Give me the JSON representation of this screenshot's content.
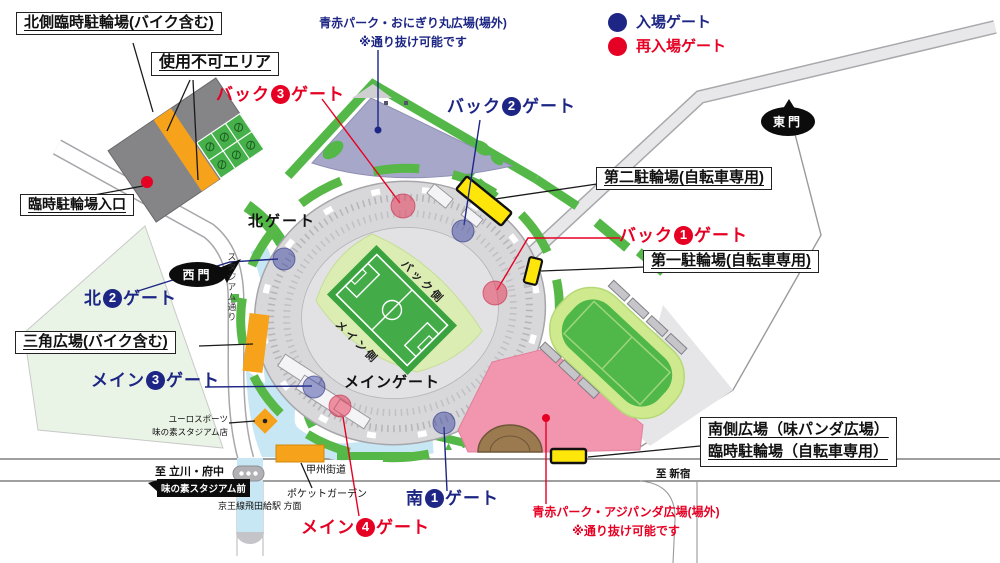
{
  "legend": {
    "entry_label": "入場ゲート",
    "reentry_label": "再入場ゲート"
  },
  "colors": {
    "entry_gate": "#1d2684",
    "reentry_gate": "#e60023",
    "park_green": "#53b848",
    "marker_yellow": "#ffe60a",
    "plaza_pink": "#f295af",
    "plaza_purple": "#a7a7c9",
    "walkway_blue": "#c8e7f4",
    "parking_orange": "#f7a21b"
  },
  "boxes": {
    "north_parking": "北側臨時駐輪場(バイク含む)",
    "unusable_area": "使用不可エリア",
    "temp_entrance": "臨時駐輪場入口",
    "triangle_plaza": "三角広場(バイク含む)",
    "bicycle2": "第二駐輪場(自転車専用)",
    "bicycle1": "第一駐輪場(自転車専用)",
    "south_plaza1": "南側広場（味パンダ広場）",
    "south_plaza2": "臨時駐輪場（自転車専用）"
  },
  "gates": {
    "back3": {
      "pre": "バック",
      "num": "3",
      "post": "ゲート"
    },
    "back2": {
      "pre": "バック",
      "num": "2",
      "post": "ゲート"
    },
    "back1": {
      "pre": "バック",
      "num": "1",
      "post": "ゲート"
    },
    "north2": {
      "pre": "北",
      "num": "2",
      "post": "ゲート"
    },
    "main3": {
      "pre": "メイン",
      "num": "3",
      "post": "ゲート"
    },
    "main4": {
      "pre": "メイン",
      "num": "4",
      "post": "ゲート"
    },
    "south1": {
      "pre": "南",
      "num": "1",
      "post": "ゲート"
    },
    "north": "北ゲート",
    "main": "メインゲート",
    "east_mon": "東門",
    "west_mon": "西門"
  },
  "plazas": {
    "onigiri_line1": "青赤パーク・おにぎり丸広場(場外)",
    "onigiri_line2": "※通り抜け可能です",
    "ajipanda_line1": "青赤パーク・アジパンダ広場(場外)",
    "ajipanda_line2": "※通り抜け可能です"
  },
  "stadium": {
    "back_side": "バック側",
    "main_side": "メイン側"
  },
  "streets": {
    "koshu_kaido": "甲州街道",
    "stadium_street": "スタジアム通り",
    "to_tachikawa": "至 立川・府中",
    "to_shinjuku": "至 新宿",
    "station_stop": "味の素スタジアム前",
    "station_direction": "京王線飛田給駅 方面",
    "pocket_garden": "ポケットガーデン",
    "shop_line1": "ユーロスポーツ",
    "shop_line2": "味の素スタジアム店"
  }
}
